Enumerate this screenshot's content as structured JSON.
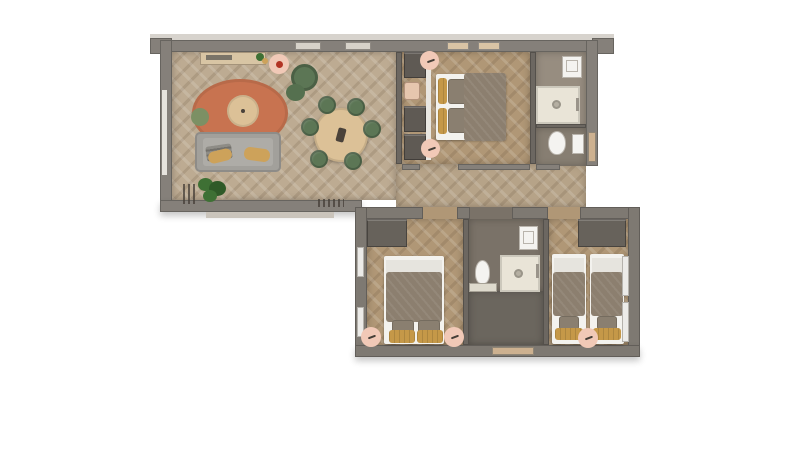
{
  "scene": {
    "description": "3D rendered apartment floor plan, top-down view on white background",
    "view": "top-down"
  },
  "colors": {
    "canvas_bg": "#ffffff",
    "wall": "#85807a",
    "wall_lower": "#7e7972",
    "wall_dark": "#6c6761",
    "wall_light": "#d7d3cd",
    "floor_living": "#bdab92",
    "floor_bedroom": "#b09776",
    "floor_corridor": "#b6a388",
    "floor_bath1_top": "#978d80",
    "floor_bath1_bottom": "#877e72",
    "floor_bath2": "#7a7268",
    "floor_hall2": "#6b665e",
    "floor_grain_light": "rgba(255,255,255,0.14)",
    "floor_grain_dark": "rgba(90,70,50,0.16)",
    "rug_terracotta": "#c87350",
    "rug_pink": "#f1c9b7",
    "wood_table": "#dcc197",
    "wood_sideboard": "#d8c5a4",
    "green_chair": "#5c7655",
    "green_pouf": "#7c9064",
    "plant_green": "#3e7034",
    "plant_dark": "#2f5a28",
    "sofa_gray": "#a2a09b",
    "sofa_seat": "#aeaca7",
    "pillow_yellow": "#cda25a",
    "pillow_yellow_deep": "#c59848",
    "pillow_gray": "#8e8c86",
    "linen_white": "#f3f2ee",
    "linen_fold": "#e6e4de",
    "blanket_taupe": "#8c7f6f",
    "cushion_taupe": "#8a7f70",
    "wardrobe_dark": "#67625b",
    "closet_box": "#5f5a54",
    "fixture_white": "#f4f3f0",
    "fixture_border": "#b9b4ac",
    "shower_cream": "#e9e4d7",
    "drain_gray": "#b5afa2",
    "metal_gray": "#9a948a",
    "radiator_white": "#ecebe8",
    "door_tan": "#cdb190",
    "step_light": "#cac4bb",
    "red_accent": "#b23324",
    "table_center_dark": "#4a423a",
    "glyph_dark": "#453e37"
  },
  "rooms": [
    {
      "name": "living-dining-room",
      "floor": "herringbone-oak",
      "items": [
        "sideboard",
        "pink-side-table",
        "green-armchair",
        "green-ottoman",
        "terracotta-rug",
        "round-coffee-table",
        "green-pouf",
        "gray-sofa",
        "yellow-throw-pillows",
        "potted-plant",
        "round-dining-table",
        "dining-chairs"
      ],
      "dining_chair_count": 6
    },
    {
      "name": "master-bedroom",
      "floor": "herringbone-oak",
      "items": [
        "closet-shelving",
        "accent-chair",
        "double-bed",
        "bedside-pouf-top",
        "bedside-pouf-bottom"
      ]
    },
    {
      "name": "bathroom-upper",
      "floor": "stone-gray",
      "items": [
        "washbasin",
        "walk-in-shower",
        "toilet",
        "wall-shelf"
      ]
    },
    {
      "name": "corridor",
      "floor": "herringbone-oak",
      "items": []
    },
    {
      "name": "bedroom-2",
      "floor": "herringbone-oak",
      "items": [
        "wardrobe",
        "double-bed",
        "bedside-rug-left",
        "bedside-rug-right",
        "radiators"
      ],
      "radiator_count": 2
    },
    {
      "name": "bathroom-lower",
      "floor": "stone-gray",
      "items": [
        "washbasin",
        "toilet",
        "walk-in-shower",
        "low-cabinet"
      ]
    },
    {
      "name": "entry-hall",
      "floor": "stone-dark",
      "items": [
        "entrance-door"
      ]
    },
    {
      "name": "bedroom-3-twin",
      "floor": "herringbone-oak",
      "items": [
        "wardrobe",
        "single-bed-left",
        "single-bed-right",
        "bedside-rug",
        "radiators"
      ],
      "single_bed_count": 2,
      "radiator_count": 2
    }
  ]
}
